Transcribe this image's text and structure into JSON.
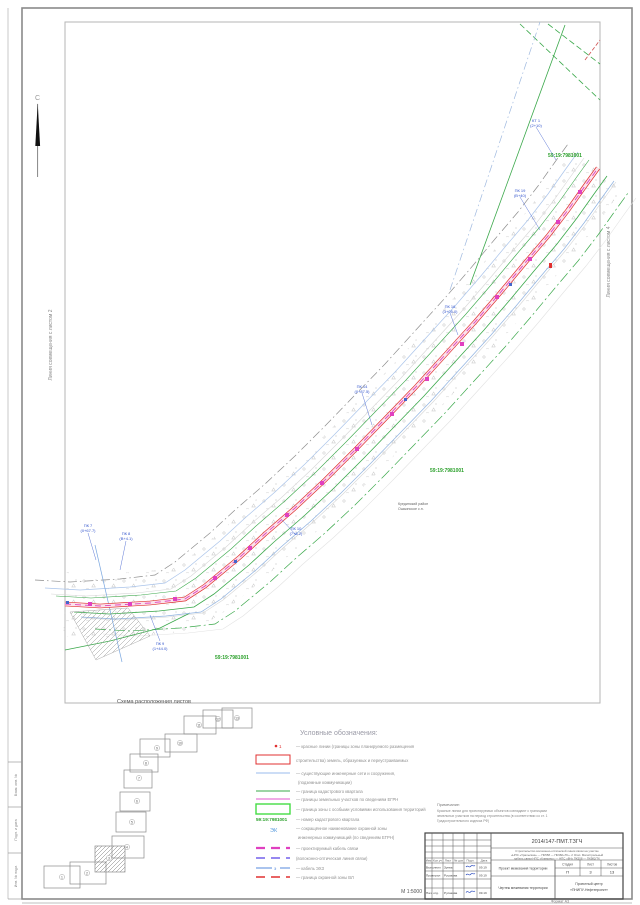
{
  "compass": {
    "label": "С"
  },
  "side": {
    "left_label": "Линия совмещения с листом 2",
    "right_label": "Линия совмещения с листом 4"
  },
  "map": {
    "cad1": "59:19:7981001",
    "cad2": "59:19:7981001",
    "cad3": "59:19:7981001",
    "area1": "Куединский район",
    "area2": "Ошьинское с.п.",
    "callouts": [
      {
        "a": "ПК 7",
        "b": "(0+67.7)"
      },
      {
        "a": "ПК 8",
        "b": "(В+4.1)"
      },
      {
        "a": "ПК 9",
        "b": "(1+44.0)"
      },
      {
        "a": "ПК 10",
        "b": "(7+6.2)"
      },
      {
        "a": "ПК 14",
        "b": "(0+87.5)"
      },
      {
        "a": "ПК 16",
        "b": "(3+05.0)"
      },
      {
        "a": "ПК 19",
        "b": "(В+40)"
      },
      {
        "a": "КТ 1",
        "b": "(2+10)"
      }
    ]
  },
  "scheme": {
    "title": "Схема расположения листов",
    "numbers": [
      "1",
      "2",
      "3",
      "4",
      "5",
      "6",
      "7",
      "8",
      "9",
      "10",
      "11",
      "12",
      "13"
    ]
  },
  "legend": {
    "title": "Условные обозначения:",
    "sample_point": "1",
    "sample_number": "59:19:7981001",
    "sample_ek": "ЭК",
    "sample_e": "э",
    "t1": "— красные линии (границы зоны планируемого размещения",
    "t2": "строительства) земель, образуемых и переустраиваемых",
    "t3a": "— существующие инженерные сети и сооружения,",
    "t3b": "(подземные коммуникации)",
    "t4": "— граница кадастрового квартала",
    "t5": "— границы земельных участков по сведениям ЕГРН",
    "t6": "— граница зоны с особыми условиями использования территорий",
    "t7": "— номер кадастрового квартала",
    "t8a": "— сокращённое наименование охранной зоны",
    "t8b": "инженерных коммуникаций (по сведениям ЕГРН)",
    "t9": "— проектируемый кабель связи",
    "t10": "(волоконно-оптическая линия связи)",
    "t11": "— кабель ЭХЗ",
    "t12": "— граница охранной зоны ВЛ"
  },
  "note": {
    "title": "Примечание:",
    "l1": "Красные линии для проектируемых объектов совпадают с границами",
    "l2": "земельных участков на период строительства (в соответствии со ст. 1",
    "l3": "Градостроительного кодекса РФ)"
  },
  "titleblock": {
    "doc": "2014/147-ПМТ.ТЗГЧ",
    "p1": "Строительство волоконно-оптической линии связи на участке",
    "p2": "«НПС «Уральская» — ПК558 — ПК982»ТК». 2 Этап. Магистральный",
    "p3": "кабель связи НПС «Климино» — НПС «8Н» ПК558 — ПК982/ТК",
    "h_izm": "Изм",
    "h_koluch": "Кол.уч",
    "h_list": "Лист",
    "h_ndok": "№ док",
    "h_podp": "Подп.",
    "h_data": "Дата",
    "r1_role": "Выполнил",
    "r1_name": "Зуева",
    "r1_date": "09.19",
    "r2_role": "Проверил",
    "r2_name": "Русакова",
    "r2_date": "09.19",
    "r3_role": "Нач. отд.",
    "r3_name": "Русакова",
    "r3_date": "09.19",
    "stage_h": "Стадия",
    "sheet_h": "Лист",
    "sheets_h": "Листов",
    "stage": "П",
    "sheet": "3",
    "sheets": "13",
    "title_main": "Проект межевания территории",
    "title_sheet": "Чертеж межевания территории",
    "org1": "Проектный центр",
    "org2": "«ПНИПУ-Нефтепроект»",
    "scale": "М 1:5000",
    "format": "Формат А3"
  },
  "strip": {
    "b1": "Взам. инв. №",
    "b2": "Подп. и дата",
    "b3": "Инв. № подл."
  }
}
